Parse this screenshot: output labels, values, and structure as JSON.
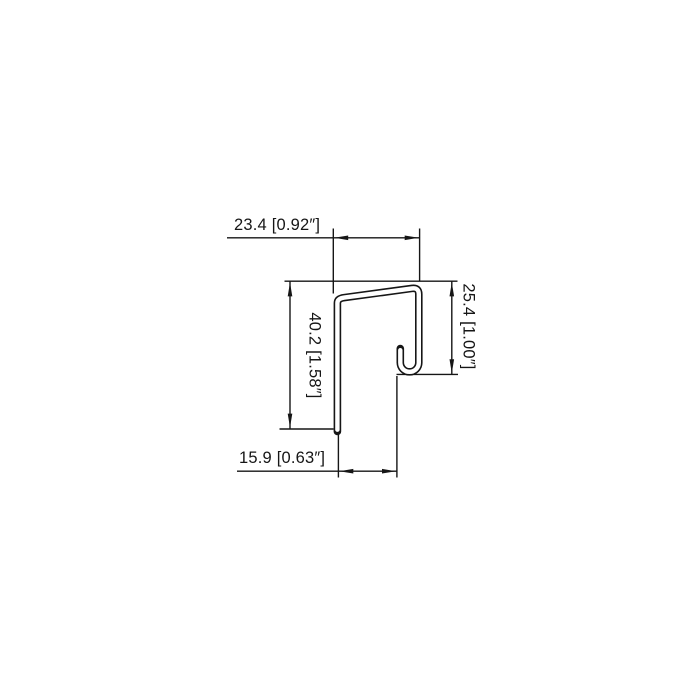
{
  "drawing": {
    "type": "technical-profile-cross-section",
    "background": "#ffffff",
    "line_color": "#161616",
    "dimensions": {
      "top_width": {
        "label": "23.4 [0.92″]",
        "mm": 23.4,
        "inch": "0.92″"
      },
      "left_height": {
        "label": "40.2 [1.58″]",
        "mm": 40.2,
        "inch": "1.58″"
      },
      "right_height": {
        "label": "25.4 [1.00″]",
        "mm": 25.4,
        "inch": "1.00″"
      },
      "bottom_width": {
        "label": "15.9 [0.63″]",
        "mm": 15.9,
        "inch": "0.63″"
      }
    }
  }
}
